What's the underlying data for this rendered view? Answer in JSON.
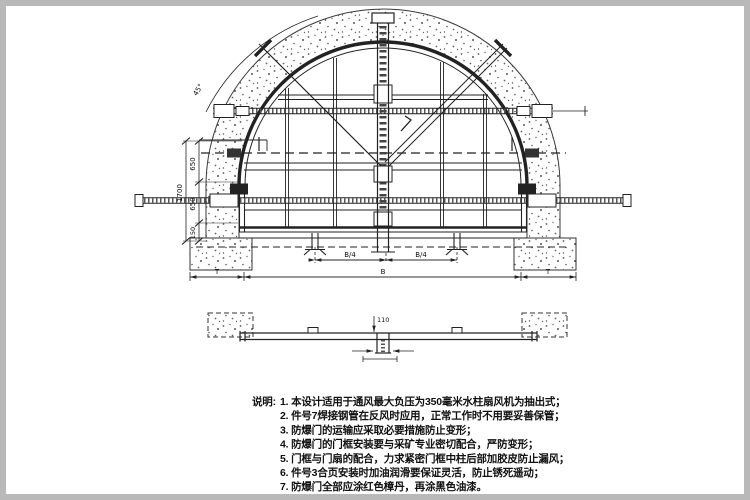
{
  "frame": {
    "border_color": "#b9b9b9",
    "background": "#ffffff"
  },
  "drawing": {
    "kind": "explosion-proof-door-elevation-and-plan",
    "line_color": "#222222",
    "dims": {
      "total_height": "1700",
      "upper_segment": "650",
      "lower_segment": "650",
      "base_segment": "150",
      "arc_angle": "45°",
      "quarter_left": "B/4",
      "quarter_right": "B/4",
      "wall_left": "T",
      "span_center": "B",
      "wall_right": "T",
      "plan_center_width": "110"
    }
  },
  "notes": {
    "label": "说明:",
    "items": [
      "1. 本设计适用于通风最大负压为350毫米水柱扇风机为抽出式；",
      "2. 件号7焊接钢管在反风时应用，正常工作时不用要妥善保管；",
      "3. 防爆门的运输应采取必要措施防止变形；",
      "4. 防爆门的门框安装要与采矿专业密切配合，严防变形；",
      "5. 门框与门扇的配合，力求紧密门框中柱后部加胶皮防止漏风；",
      "6. 件号3合页安装时加油润滑要保证灵活，防止锈死遥动；",
      "7. 防爆门全部应涂红色樟丹，再涂黑色油漆。"
    ]
  }
}
